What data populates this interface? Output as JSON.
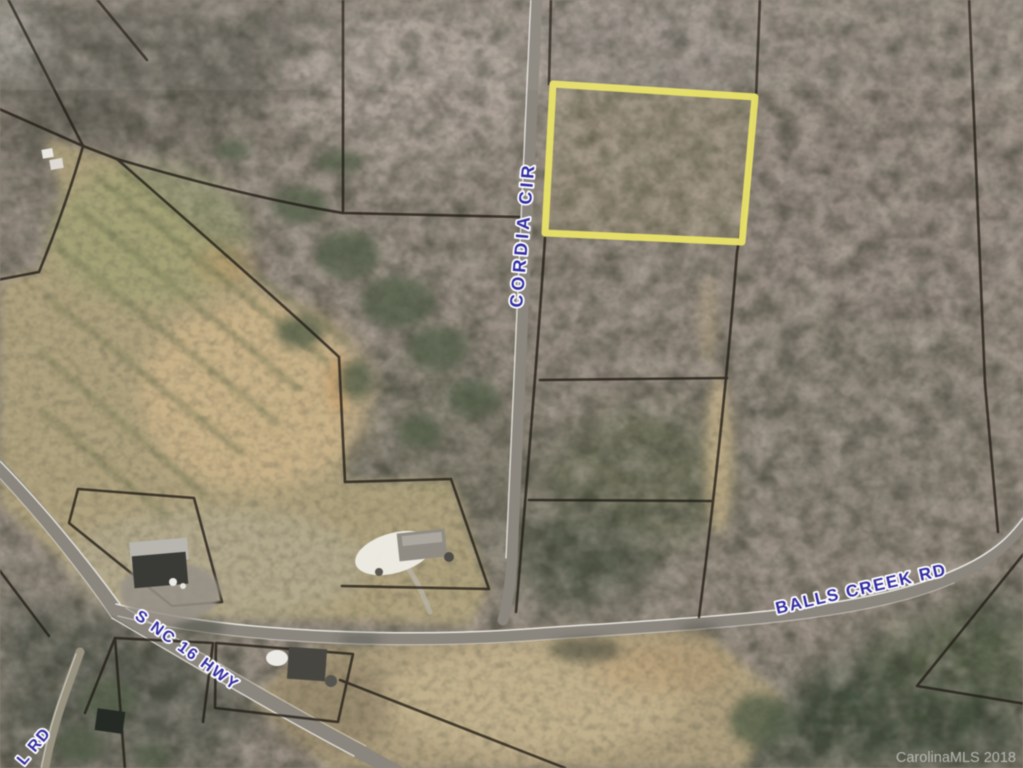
{
  "map": {
    "road_labels": [
      {
        "id": "cordia-cir",
        "text": "CORDIA CIR"
      },
      {
        "id": "balls-creek-rd",
        "text": "BALLS CREEK RD"
      },
      {
        "id": "s-nc-16-hwy",
        "text": "S NC 16 HWY"
      },
      {
        "id": "l-rd",
        "text": "L RD"
      }
    ],
    "watermark": {
      "text": "CarolinaMLS 2018"
    },
    "highlighted_parcel": {
      "outline_color": "#e9e163"
    },
    "colors": {
      "road_label_blue": "#322da6",
      "road_label_halo": "#ffffff",
      "parcel_line": "#241f18",
      "watermark_gray": "#c9c9c7",
      "field_tan": "#b5a67d",
      "woods_gray_brown": "#93897d",
      "woods_dark_green": "#475140",
      "road_pavement": "#8a857d"
    }
  }
}
